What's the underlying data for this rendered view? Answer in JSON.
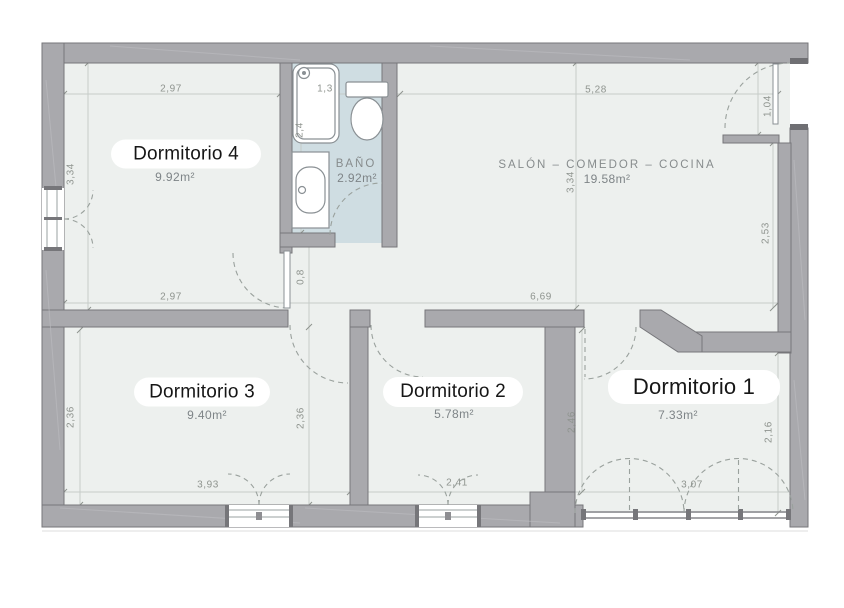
{
  "rooms": {
    "dormitorio4": {
      "name": "Dormitorio 4",
      "area": "9.92m²"
    },
    "bano": {
      "name": "BAÑO",
      "area": "2.92m²"
    },
    "salon": {
      "name": "SALÓN  –  COMEDOR  –  COCINA",
      "area": "19.58m²"
    },
    "dormitorio3": {
      "name": "Dormitorio 3",
      "area": "9.40m²"
    },
    "dormitorio2": {
      "name": "Dormitorio 2",
      "area": "5.78m²"
    },
    "dormitorio1": {
      "name": "Dormitorio 1",
      "area": "7.33m²"
    }
  },
  "dimensions": {
    "d4_top": "2,97",
    "d4_left": "3,34",
    "d4_bottom": "2,97",
    "bath_top": "1,3",
    "bath_left": "2,4",
    "salon_top": "5,28",
    "salon_mid": "3,34",
    "salon_right": "2,53",
    "salon_bottom": "6,69",
    "entry": "1,04",
    "hall": "0,8",
    "d3_left": "2,36",
    "d3_right": "2,36",
    "d3_bottom": "3,93",
    "d2_bottom": "2,41",
    "d2_right": "2,46",
    "d1_bottom": "3,07",
    "d1_right": "2,16"
  },
  "colors": {
    "wall": "#a9a9ad",
    "wall_outline": "#76767a",
    "floor": "#edf0ee",
    "bathroom_floor": "#cfdde2",
    "dimension_text": "#8f948f",
    "room_label_text": "#161616",
    "area_text": "#7e8487",
    "label_pill": "#ffffff"
  }
}
